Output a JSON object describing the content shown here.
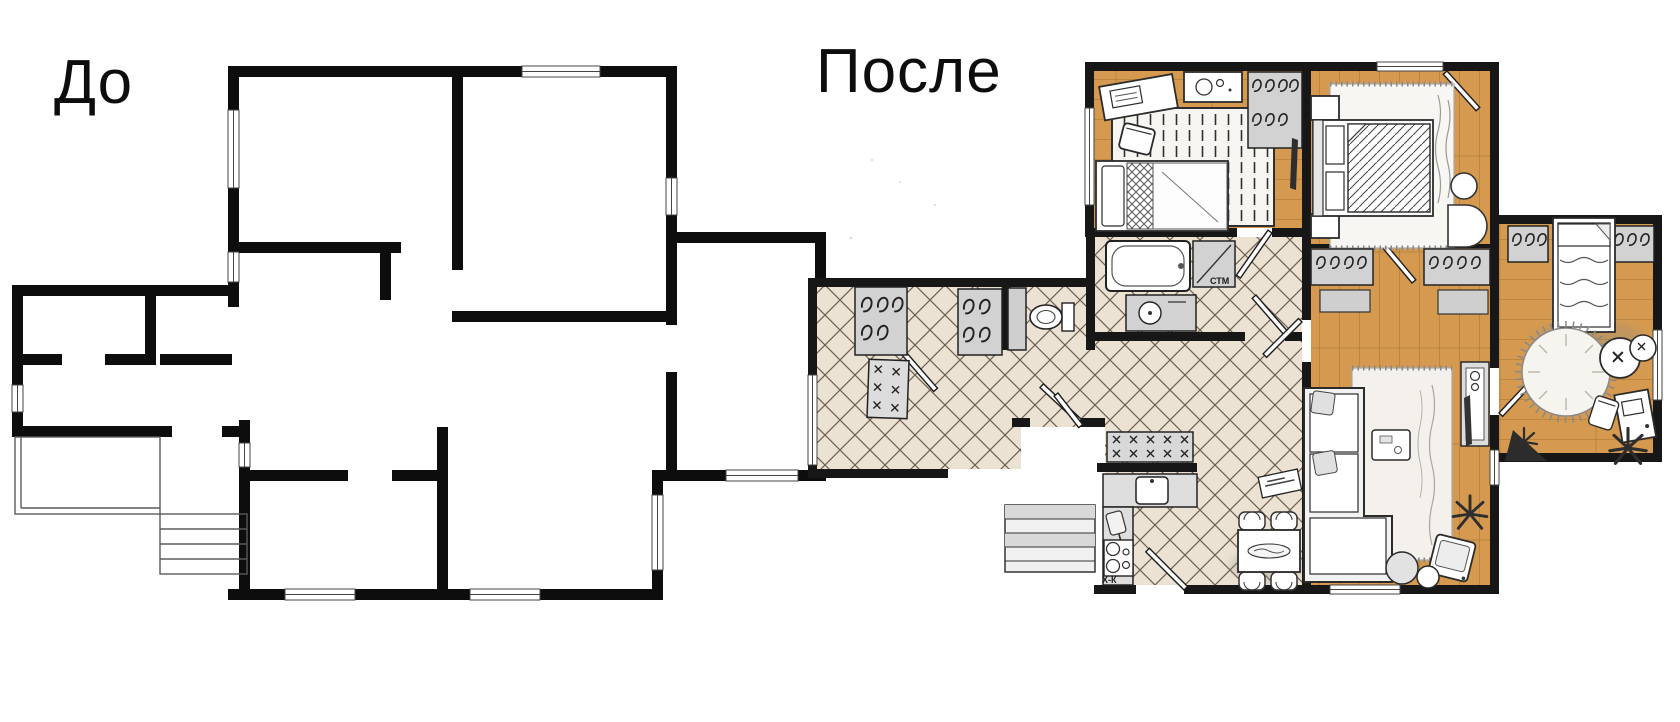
{
  "labels": {
    "before": "До",
    "after": "После",
    "washing_machine": "СТМ",
    "fridge": "Х-К"
  },
  "colors": {
    "paper": "#ffffff",
    "wall": "#0d0d0d",
    "wood": "#d59a50",
    "wood_line": "#a8762f",
    "tile": "#ece2d4",
    "tile_line": "#4b3e2f",
    "gray": "#d2d2d2",
    "shadow": "#8a8a8a"
  }
}
